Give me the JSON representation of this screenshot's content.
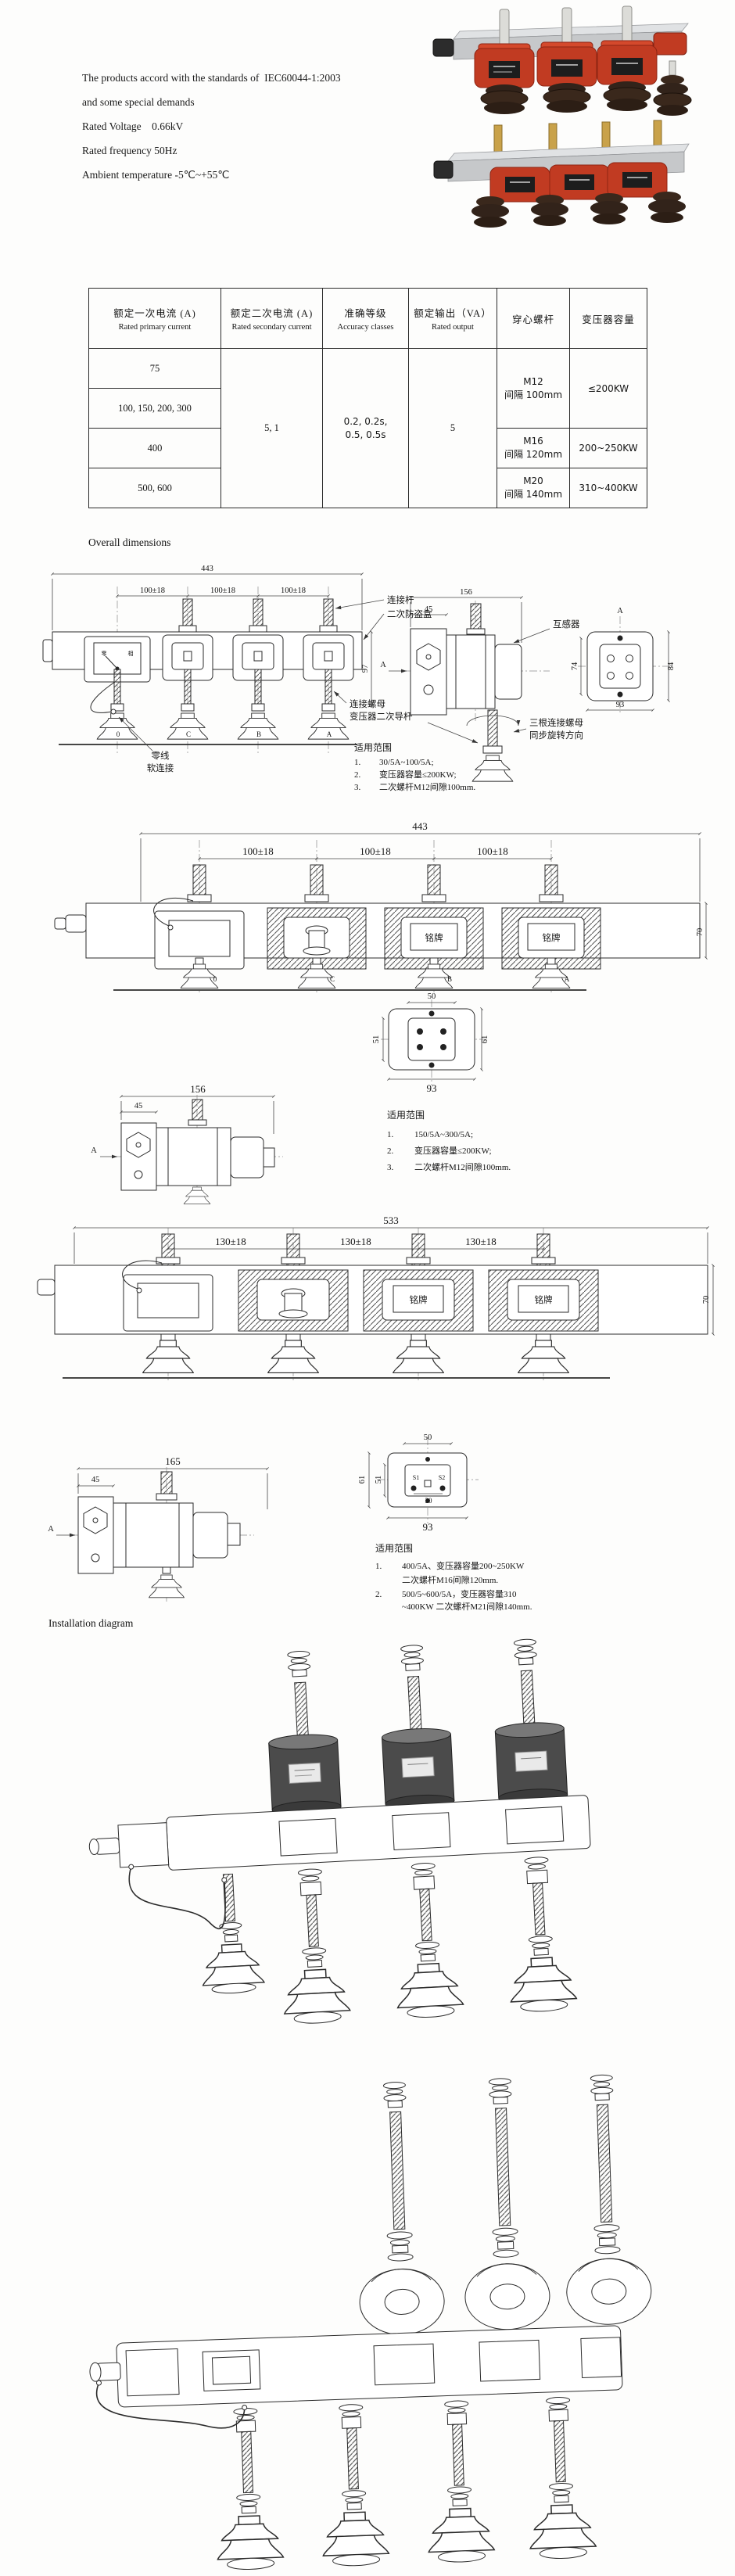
{
  "intro": {
    "line1": "The products accord with the standards of  IEC60044-1:2003",
    "line2": "and some special demands",
    "voltage": "Rated Voltage    0.66kV",
    "frequency": "Rated frequency 50Hz",
    "ambient": "Ambient temperature -5℃~+55℃"
  },
  "headings": {
    "overall": "Overall dimensions",
    "installation": "Installation diagram"
  },
  "table": {
    "h_primary_zh": "额定一次电流 (A)",
    "h_primary_en": "Rated primary current",
    "h_secondary_zh": "额定二次电流 (A)",
    "h_secondary_en": "Rated secondary current",
    "h_accuracy_zh": "准确等级",
    "h_accuracy_en": "Accuracy classes",
    "h_output_zh": "额定输出（VA）",
    "h_output_en": "Rated output",
    "h_bolt_zh": "穿心螺杆",
    "h_capacity_zh": "变压器容量",
    "primary_r1": "75",
    "primary_r2": "100, 150, 200, 300",
    "primary_r3": "400",
    "primary_r4": "500, 600",
    "secondary": "5, 1",
    "accuracy_l1": "0.2, 0.2s,",
    "accuracy_l2": "0.5, 0.5s",
    "output": "5",
    "bolt1_l1": "M12",
    "bolt1_l2": "间隔 100mm",
    "bolt2_l1": "M16",
    "bolt2_l2": "间隔 120mm",
    "bolt3_l1": "M20",
    "bolt3_l2": "间隔 140mm",
    "cap1": "≤200KW",
    "cap2": "200~250KW",
    "cap3": "310~400KW"
  },
  "d1": {
    "total": "443",
    "pitch": "100±18",
    "side_w": "156",
    "side_off": "45",
    "height": "97",
    "face_l": "74",
    "face_r": "84",
    "face_w": "93",
    "sec_a": "A",
    "face_a": "A",
    "gauge_l": "零",
    "gauge_r": "相",
    "connecting_rod": "连接杆",
    "antitheft_box": "二次防盗盒",
    "transformer": "互感器",
    "neutral_l1": "零线",
    "neutral_l2": "软连接",
    "nut": "连接螺母",
    "secondary_rod": "变压器二次导杆",
    "rotate_l1": "三根连接螺母",
    "rotate_l2": "同步旋转方向",
    "ph1": "0",
    "ph2": "C",
    "ph3": "B",
    "ph4": "A",
    "scope_title": "适用范围",
    "s1n": "1.",
    "s1": "30/5A~100/5A;",
    "s2n": "2.",
    "s2": "变压器容量≤200KW;",
    "s3n": "3.",
    "s3": "二次螺杆M12间隙100mm."
  },
  "d2": {
    "total": "443",
    "pitch": "100±18",
    "bar_h": "70",
    "nameplate": "铭牌",
    "side_w": "156",
    "side_off": "45",
    "sec_a": "A",
    "face_top": "50",
    "face_l": "51",
    "face_r": "61",
    "face_w": "93",
    "ph1": "0",
    "ph2": "C",
    "ph3": "B",
    "ph4": "A",
    "scope_title": "适用范围",
    "s1n": "1.",
    "s1": "150/5A~300/5A;",
    "s2n": "2.",
    "s2": "变压器容量≤200KW;",
    "s3n": "3.",
    "s3": "二次螺杆M12间隙100mm."
  },
  "d3": {
    "total": "533",
    "pitch": "130±18",
    "bar_h": "70",
    "nameplate": "铭牌",
    "side_w": "165",
    "side_off": "45",
    "sec_a": "A",
    "face_top": "50",
    "face_l1": "61",
    "face_l2": "51",
    "face_inner": "30",
    "face_w": "93",
    "t_s1": "S1",
    "t_s2": "S2",
    "scope_title": "适用范围",
    "s1n": "1.",
    "s1a": "400/5A、变压器容量200~250KW",
    "s1b": "二次螺杆M16间隙120mm.",
    "s2n": "2.",
    "s2a": "500/5~600/5A，变压器容量310",
    "s2b": "~400KW 二次螺杆M21间隙140mm."
  },
  "colors": {
    "ct_red": "#c13b22",
    "ct_red_dark": "#8e2413",
    "insulator_brown": "#32231a",
    "bar_gray": "#c6c8ca",
    "brass": "#c9a24a"
  }
}
